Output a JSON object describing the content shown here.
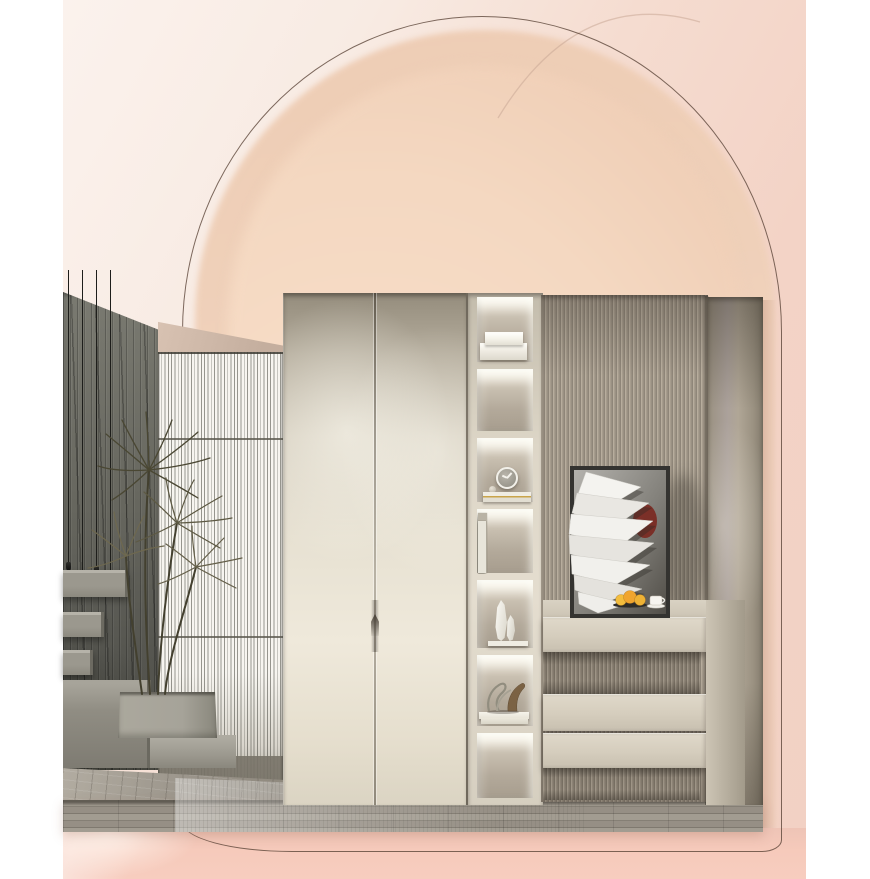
{
  "meta": {
    "description": "Product showcase render: cream two-door wardrobe with backlit open shelving, fluted drawer unit and abstract art, staged before a pink arched backdrop with concrete stair vignette",
    "canvas": {
      "width": 870,
      "height": 879
    }
  },
  "colors": {
    "page_bg": "#ffffff",
    "blush_top": "#fbf2ed",
    "pink_outer": "#f3d3c6",
    "pink_band": "#f6cabb",
    "arch_outer": "#eecdb5",
    "arch_inner": "#f4d8c1",
    "arch_inner_glow": "#fbe7d6",
    "outline": "#5f4b40",
    "faint_arc": "#c9a896",
    "wall_dark": "#66665e",
    "wall_darker": "#4d4d46",
    "soffit": "#c4ae9e",
    "screen_white": "#f7f5f0",
    "cord": "#1e1e1b",
    "concrete": "#9b988e",
    "door_base": "#dbd4c3",
    "door_top_shadow": "#948c7c",
    "door_bright": "#efe9db",
    "seam": "#4a4238",
    "frame_cream": "#ddd6c7",
    "cell_back": "#b3a99a",
    "gold": "#c9a44a",
    "book_black": "#24221f",
    "fluted_base": "#a69c8d",
    "fluted_dark": "#8f8679",
    "right_panel": "#aba19b",
    "drawer_face": "#d5cdbd",
    "ledge_dark": "#3d3c36",
    "art_frame": "#343330",
    "art_accent": "#7a221a",
    "fruit_yellow": "#f0ab31",
    "floor": "#9a948a",
    "floor_dark": "#837d72",
    "plant_dark": "#4d4936",
    "planter_gray": "#a3a196"
  },
  "scene": {
    "labels": {
      "backdrop": "Arched pink backdrop",
      "wardrobe": "Two-door wardrobe cabinet",
      "handle": "Door pull handle",
      "shelf_column": "Backlit open display shelving",
      "fluted_wall": "Fluted panel wall",
      "right_panel": "Side cabinet panel",
      "drawers": "Drawer unit with fluted recesses",
      "artwork": "Abstract folded-paper wall art",
      "ledge": "Dark display ledge with fruit and coffee cup",
      "screen": "Slatted room divider screen",
      "wall": "Textured concrete feature wall",
      "stairs": "Floating concrete stairs",
      "pendants": "Pendant lights",
      "plant": "Potted dracaena plant",
      "floor": "Wood plank floor"
    },
    "shelf_items": [
      "stacked storage boxes",
      "empty lit shelf",
      "wall clock with book stack",
      "row of books",
      "two faceted white vases",
      "sculptures on magazines",
      "empty lit shelf"
    ],
    "ledge_props": [
      "citrus fruits",
      "white coffee cup and saucer"
    ]
  }
}
